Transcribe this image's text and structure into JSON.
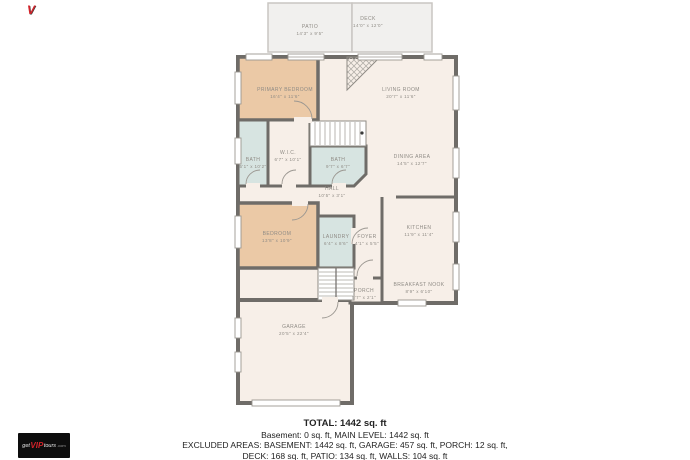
{
  "watermark": {
    "mark": "V",
    "get": "get",
    "vip": "VIP",
    "tours": "tours",
    "dotcom": ".com"
  },
  "colors": {
    "wall": "#6f6c68",
    "room_cream": "#f7efe8",
    "room_peach": "#ebc9a6",
    "room_blue": "#d7e4e1",
    "outdoor_gray": "#f1f0ee",
    "label_text": "#8f8b85",
    "accent_red": "#d2232a"
  },
  "rooms": {
    "patio": {
      "name": "PATIO",
      "dims": "14'3\" x 9'5\""
    },
    "deck": {
      "name": "DECK",
      "dims": "14'0\" x 12'0\""
    },
    "primary_bedroom": {
      "name": "PRIMARY BEDROOM",
      "dims": "16'4\" x 11'6\""
    },
    "living_room": {
      "name": "LIVING ROOM",
      "dims": "20'7\" x 11'6\""
    },
    "bath_left": {
      "name": "BATH",
      "dims": "5'1\" x 10'2\""
    },
    "wic": {
      "name": "W.I.C.",
      "dims": "6'7\" x 10'1\""
    },
    "bath_main": {
      "name": "BATH",
      "dims": "9'7\" x 6'7\""
    },
    "dining_area": {
      "name": "DINING AREA",
      "dims": "14'5\" x 12'7\""
    },
    "hall": {
      "name": "HALL",
      "dims": "10'5\" x 3'1\""
    },
    "bedroom": {
      "name": "BEDROOM",
      "dims": "13'8\" x 10'9\""
    },
    "laundry": {
      "name": "LAUNDRY",
      "dims": "6'4\" x 8'6\""
    },
    "foyer": {
      "name": "FOYER",
      "dims": "4'1\" x 5'5\""
    },
    "kitchen": {
      "name": "KITCHEN",
      "dims": "11'9\" x 11'4\""
    },
    "breakfast_nook": {
      "name": "BREAKFAST NOOK",
      "dims": "8'9\" x 6'10\""
    },
    "porch": {
      "name": "PORCH",
      "dims": "5'7\" x 2'1\""
    },
    "garage": {
      "name": "GARAGE",
      "dims": "20'5\" x 22'4\""
    }
  },
  "summary": {
    "total": "TOTAL: 1442 sq. ft",
    "line2": "Basement: 0 sq. ft, MAIN LEVEL: 1442 sq. ft",
    "line3": "EXCLUDED AREAS: BASEMENT: 1442 sq. ft, GARAGE: 457 sq. ft, PORCH: 12 sq. ft,",
    "line4": "DECK: 168 sq. ft, PATIO: 134 sq. ft, WALLS: 104 sq. ft"
  }
}
